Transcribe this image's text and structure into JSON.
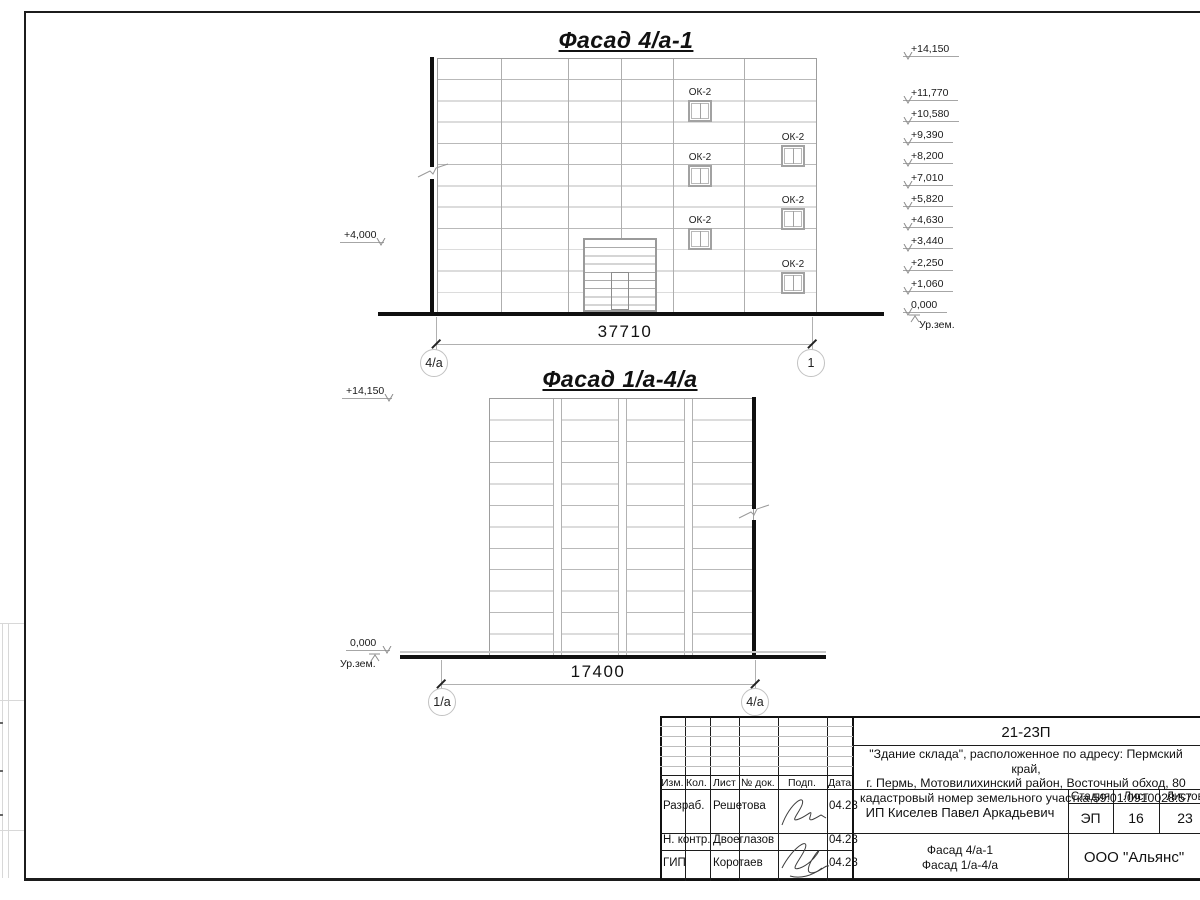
{
  "sheet": {
    "project_code": "21-23П",
    "description_line1": "\"Здание склада\", расположенное по адресу: Пермский край,",
    "description_line2": "г. Пермь, Мотовилихинский район, Восточный обход, 80",
    "description_line3": "кадастровый номер земельного участка 59:01:0910028:57",
    "client": "ИП Киселев Павел Аркадьевич",
    "content_line1": "Фасад 4/а-1",
    "content_line2": "Фасад 1/а-4/а",
    "company": "ООО \"Альянс\"",
    "stamp": {
      "col_izm": "Изм.",
      "col_kol": "Кол.",
      "col_list": "Лист",
      "col_doc": "№ док.",
      "col_podp": "Подп.",
      "col_data": "Дата",
      "row1_role": "Разраб.",
      "row1_name": "Решетова",
      "row1_date": "04.23",
      "row2_role": "Н. контр.",
      "row2_name": "Двоеглазов",
      "row2_date": "04.23",
      "row3_role": "ГИП",
      "row3_name": "Коротаев",
      "row3_date": "04.23",
      "stage_label": "Стадия",
      "sheet_label": "Лист",
      "sheets_label": "Листов",
      "stage": "ЭП",
      "sheet_no": "16",
      "sheets_total": "23"
    }
  },
  "facade1": {
    "title": "Фасад 4/а-1",
    "dimension": "37710",
    "axis_left": "4/a",
    "axis_right": "1",
    "window_label": "ОК-2",
    "left_mark": "+4,000",
    "ground_label": "Ур.зем.",
    "elevations": [
      "+14,150",
      "+11,770",
      "+10,580",
      "+9,390",
      "+8,200",
      "+7,010",
      "+5,820",
      "+4,630",
      "+3,440",
      "+2,250",
      "+1,060",
      "0,000"
    ]
  },
  "facade2": {
    "title": "Фасад 1/а-4/а",
    "dimension": "17400",
    "axis_left": "1/a",
    "axis_right": "4/a",
    "top_mark": "+14,150",
    "zero_mark": "0,000",
    "ground_label": "Ур.зем."
  }
}
